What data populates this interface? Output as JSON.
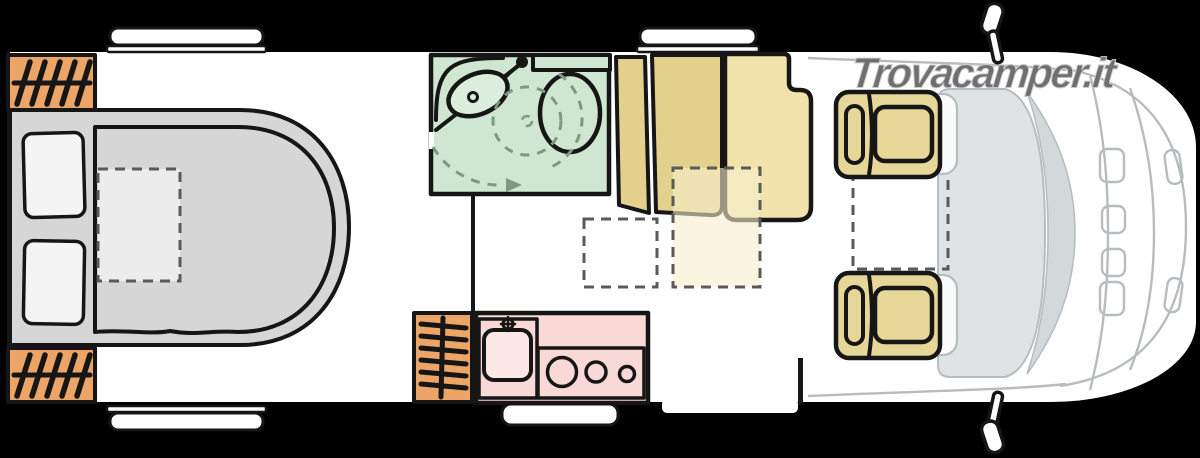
{
  "watermark": {
    "text": "Trovacamper.it"
  },
  "plan": {
    "type": "camper-floorplan-top-view",
    "areas": [
      {
        "name": "island-bed",
        "desc": "rear island bed with two pillows and dashed pad"
      },
      {
        "name": "rear-heater-vent",
        "desc": "orange hatched vent top-left"
      },
      {
        "name": "rear-heater-vent-2",
        "desc": "orange hatched vent bottom-left"
      },
      {
        "name": "bathroom",
        "desc": "green wet room with sink, toilet, dashed shower swing arcs"
      },
      {
        "name": "wardrobe",
        "desc": "two tan wardrobe panels"
      },
      {
        "name": "dinette-bench",
        "desc": "tan bench seat with headrest notch"
      },
      {
        "name": "dinette-table",
        "desc": "dashed translucent table outline"
      },
      {
        "name": "floor-marker",
        "desc": "dashed white floor square"
      },
      {
        "name": "kitchen",
        "desc": "pink kitchen block with sink and 3-burner hob"
      },
      {
        "name": "kitchen-heater",
        "desc": "orange hatched heater beside kitchen"
      },
      {
        "name": "cab-passenger-seat",
        "desc": "tan swivel seat"
      },
      {
        "name": "cab-driver-seat",
        "desc": "tan swivel seat"
      },
      {
        "name": "cab",
        "desc": "cab with windshield, hood, grille, headlights"
      },
      {
        "name": "roof-vents",
        "desc": "four white roof vents"
      },
      {
        "name": "wing-mirrors",
        "desc": "top and bottom wing mirrors"
      }
    ]
  },
  "colors": {
    "background": "#000000",
    "body": "#ffffff",
    "outline": "#161616",
    "bed_grey": "#d6d6d6",
    "bed_pad": "#ececec",
    "pillow": "#f4f4f4",
    "heater_orange": "#eca566",
    "bath_green": "#cfe7d1",
    "fixture_green": "#daeedb",
    "dash_green": "#7d997f",
    "wood_dark": "#e4d08d",
    "wood_light": "#f1e3ab",
    "seat_tan": "#e6d697",
    "table_tint": "rgba(246,238,205,0.6)",
    "kitchen_pink": "#f8d9d5",
    "sink_pink": "#fbe8e4",
    "dash_grey": "#5a5a5a",
    "cab_floor": "#e0e3e4",
    "windshield": "#d3d8da",
    "cab_line": "#b6bcbf",
    "watermark_grey": "#6f6f6f"
  }
}
